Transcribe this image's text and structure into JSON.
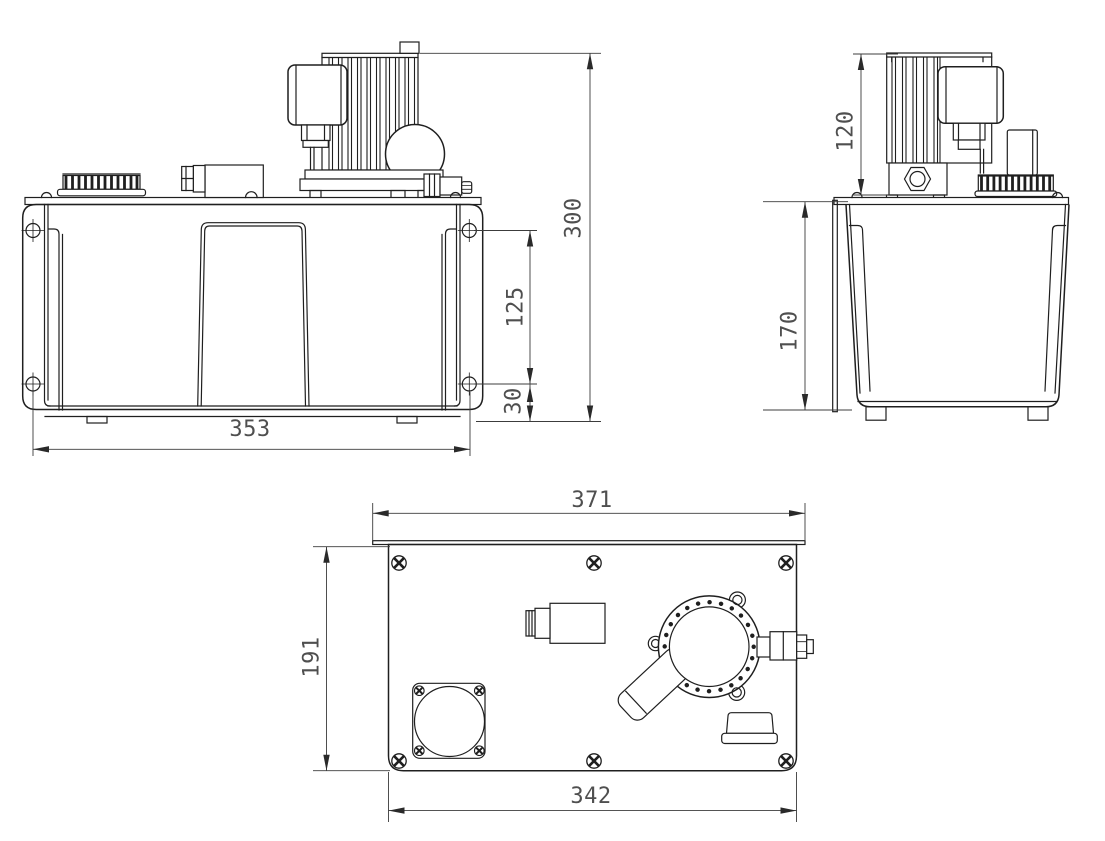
{
  "dimensions": {
    "front": {
      "overall_height": "300",
      "hole_spacing_vertical": "125",
      "hole_to_base": "30",
      "hole_spacing_horizontal": "353"
    },
    "side": {
      "motor_above_plate": "120",
      "tank_depth": "170"
    },
    "top": {
      "flange_width": "371",
      "plate_depth": "191",
      "body_width": "342"
    }
  },
  "accent_colors": {
    "line": "#1f1f1f",
    "dimension": "#4f4f4f",
    "background": "#ffffff"
  }
}
